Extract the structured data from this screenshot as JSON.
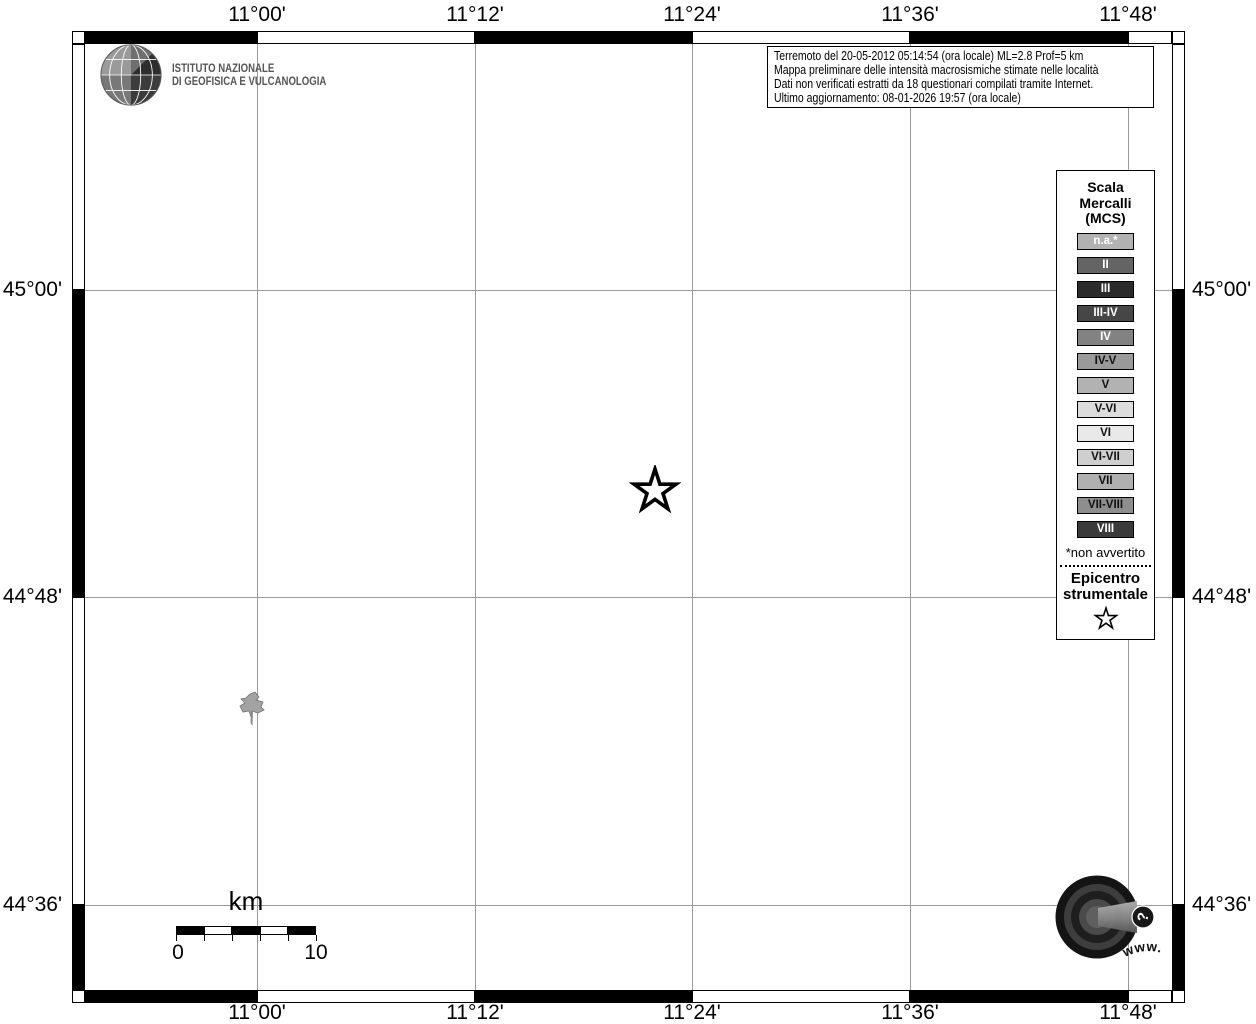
{
  "branding": {
    "ingv_name_line1": "ISTITUTO NAZIONALE",
    "ingv_name_line2": "DI GEOFISICA E VULCANOLOGIA"
  },
  "info_box": {
    "line1": "Terremoto del 20-05-2012 05:14:54 (ora locale) ML=2.8 Prof=5 km",
    "line2": "Mappa preliminare delle intensità macrosismiche stimate nelle località",
    "line3": "Dati non verificati estratti da 18 questionari compilati tramite Internet.",
    "line4": "Ultimo aggiornamento: 08-01-2026 19:57 (ora locale)"
  },
  "legend": {
    "title_line1": "Scala",
    "title_line2": "Mercalli",
    "title_line3": "(MCS)",
    "items": [
      {
        "label": "n.a.*",
        "bg": "#b2b2b2",
        "fg": "#ffffff"
      },
      {
        "label": "II",
        "bg": "#646464",
        "fg": "#ffffff"
      },
      {
        "label": "III",
        "bg": "#2b2b2b",
        "fg": "#ffffff"
      },
      {
        "label": "III-IV",
        "bg": "#464646",
        "fg": "#ffffff"
      },
      {
        "label": "IV",
        "bg": "#828282",
        "fg": "#ffffff"
      },
      {
        "label": "IV-V",
        "bg": "#9a9a9a",
        "fg": "#111111"
      },
      {
        "label": "V",
        "bg": "#b2b2b2",
        "fg": "#111111"
      },
      {
        "label": "V-VI",
        "bg": "#dcdcdc",
        "fg": "#111111"
      },
      {
        "label": "VI",
        "bg": "#e9e9e9",
        "fg": "#111111"
      },
      {
        "label": "VI-VII",
        "bg": "#cfcfcf",
        "fg": "#111111"
      },
      {
        "label": "VII",
        "bg": "#b0b0b0",
        "fg": "#111111"
      },
      {
        "label": "VII-VIII",
        "bg": "#8e8e8e",
        "fg": "#111111"
      },
      {
        "label": "VIII",
        "bg": "#3a3a3a",
        "fg": "#ffffff"
      }
    ],
    "footnote": "*non avvertito",
    "epicenter_line1": "Epicentro",
    "epicenter_line2": "strumentale"
  },
  "map": {
    "lon_ticks": [
      {
        "label": "11°00'",
        "x": 257
      },
      {
        "label": "11°12'",
        "x": 475
      },
      {
        "label": "11°24'",
        "x": 692
      },
      {
        "label": "11°36'",
        "x": 910
      },
      {
        "label": "11°48'",
        "x": 1128
      }
    ],
    "lat_ticks": [
      {
        "label": "45°00'",
        "y": 290
      },
      {
        "label": "44°48'",
        "y": 597
      },
      {
        "label": "44°36'",
        "y": 905
      }
    ],
    "epicenter_px": {
      "x": 655,
      "y": 491
    },
    "locality_px": {
      "x": 253,
      "y": 706
    }
  },
  "scalebar": {
    "title": "km",
    "start_label": "0",
    "end_label": "10"
  },
  "footer_logo": {
    "circular_text": "www.haisentitoilterremoto.it",
    "question_mark": "?"
  }
}
